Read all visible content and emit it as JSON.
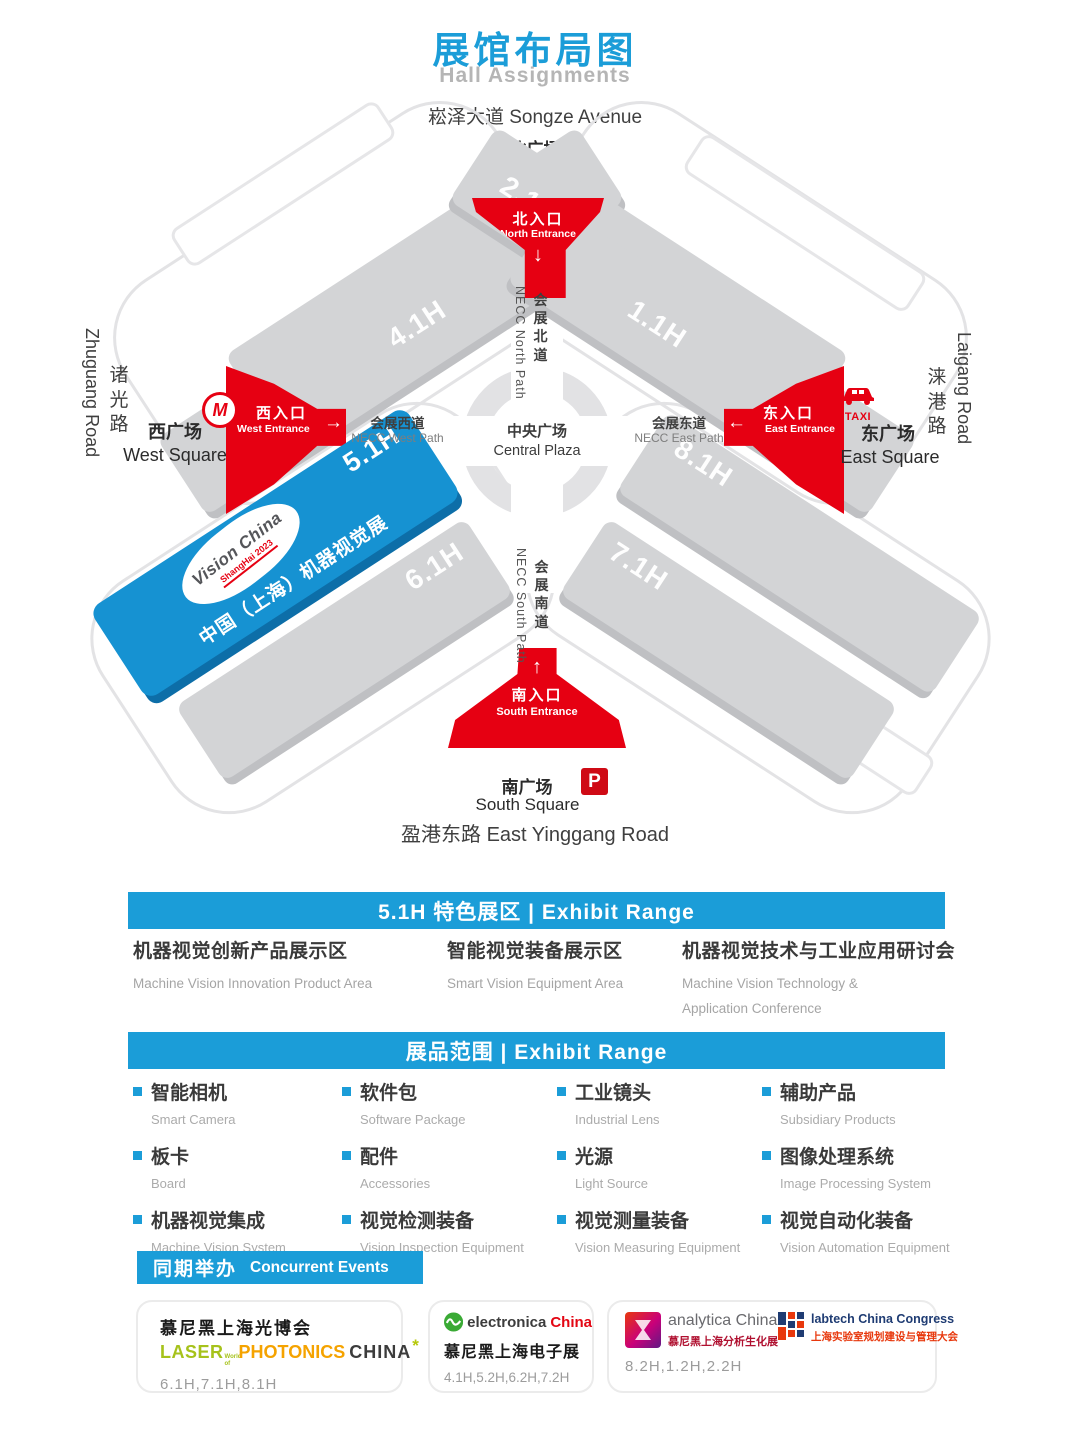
{
  "header": {
    "title_cn": "展馆布局图",
    "title_en": "Hall Assignments"
  },
  "colors": {
    "accent_blue": "#1b9dd8",
    "entrance_red": "#e60012",
    "hall_blue": "#1692d2",
    "slab_gray": "#d3d4d6",
    "laser_green": "#a6c21b",
    "photonics_orange": "#f5a300",
    "electronica_red": "#e30613",
    "labtech_navy": "#1f3c73",
    "analytica_red": "#e8380d"
  },
  "map": {
    "roads": {
      "top": "崧泽大道 Songze Avenue",
      "left_cn": "诸光路",
      "left_en": "Zhuguang Road",
      "right_cn": "涞港路",
      "right_en": "Laigang Road",
      "bottom": "盈港东路 East Yinggang Road"
    },
    "squares": {
      "north_cn": "北广场",
      "north_en": "North Square",
      "west_cn": "西广场",
      "west_en": "West Square",
      "east_cn": "东广场",
      "east_en": "East Square",
      "south_cn": "南广场",
      "south_en": "South Square"
    },
    "entrances": {
      "north": {
        "cn": "北入口",
        "en": "North Entrance",
        "arrow": "↓"
      },
      "west": {
        "cn": "西入口",
        "en": "West Entrance",
        "arrow": "→"
      },
      "east": {
        "cn": "东入口",
        "en": "East Entrance",
        "arrow": "←"
      },
      "south": {
        "cn": "南入口",
        "en": "South Entrance",
        "arrow": "↑"
      }
    },
    "paths": {
      "north_cn": "会展北道",
      "north_en": "NECC North Path",
      "south_cn": "会展南道",
      "south_en": "NECC South Path",
      "west_cn": "会展西道",
      "west_en": "NECC West Path",
      "east_cn": "会展东道",
      "east_en": "NECC East Path",
      "center_cn": "中央广场",
      "center_en": "Central Plaza"
    },
    "halls": {
      "h11": "1.1H",
      "h21": "2.1H",
      "h31": "3.1H",
      "h41": "4.1H",
      "h51": "5.1H",
      "h61": "6.1H",
      "h71": "7.1H",
      "h81": "8.1H"
    },
    "vision_hall": {
      "logo_line1": "Vision China",
      "logo_line2": "ShangHai 2023",
      "label": "中国（上海）机器视觉展"
    },
    "icons": {
      "metro": "M",
      "taxi": "TAXI",
      "parking": "P"
    }
  },
  "sections": {
    "featured": {
      "bar": "5.1H 特色展区 | Exhibit Range",
      "items": [
        {
          "cn": "机器视觉创新产品展示区",
          "en": "Machine Vision Innovation Product Area"
        },
        {
          "cn": "智能视觉装备展示区",
          "en": "Smart Vision Equipment Area"
        },
        {
          "cn": "机器视觉技术与工业应用研讨会",
          "en": "Machine Vision Technology & Application Conference"
        }
      ]
    },
    "range": {
      "bar": "展品范围 | Exhibit Range",
      "items": [
        {
          "cn": "智能相机",
          "en": "Smart Camera"
        },
        {
          "cn": "软件包",
          "en": "Software Package"
        },
        {
          "cn": "工业镜头",
          "en": "Industrial Lens"
        },
        {
          "cn": "辅助产品",
          "en": "Subsidiary Products"
        },
        {
          "cn": "板卡",
          "en": "Board"
        },
        {
          "cn": "配件",
          "en": "Accessories"
        },
        {
          "cn": "光源",
          "en": "Light Source"
        },
        {
          "cn": "图像处理系统",
          "en": "Image Processing System"
        },
        {
          "cn": "机器视觉集成",
          "en": "Machine Vision System"
        },
        {
          "cn": "视觉检测装备",
          "en": "Vision Inspection Equipment"
        },
        {
          "cn": "视觉测量装备",
          "en": "Vision Measuring Equipment"
        },
        {
          "cn": "视觉自动化装备",
          "en": "Vision Automation Equipment"
        }
      ]
    },
    "concurrent": {
      "bar_cn": "同期举办",
      "bar_en": "Concurrent Events",
      "cards": [
        {
          "title": "慕尼黑上海光博会",
          "logo_laser": "LASER",
          "logo_worldof": "World of",
          "logo_photonics": "PHOTONICS",
          "logo_china": "CHINA",
          "logo_spark": "*",
          "halls": "6.1H,7.1H,8.1H"
        },
        {
          "logo_main": "electronica",
          "logo_suffix": "China",
          "title": "慕尼黑上海电子展",
          "halls": "4.1H,5.2H,6.2H,7.2H"
        },
        {
          "logo1_en": "analytica China",
          "logo1_cn": "慕尼黑上海分析生化展",
          "logo2_en": "labtech China Congress",
          "logo2_cn": "上海实验室规划建设与管理大会",
          "halls": "8.2H,1.2H,2.2H"
        }
      ]
    }
  }
}
